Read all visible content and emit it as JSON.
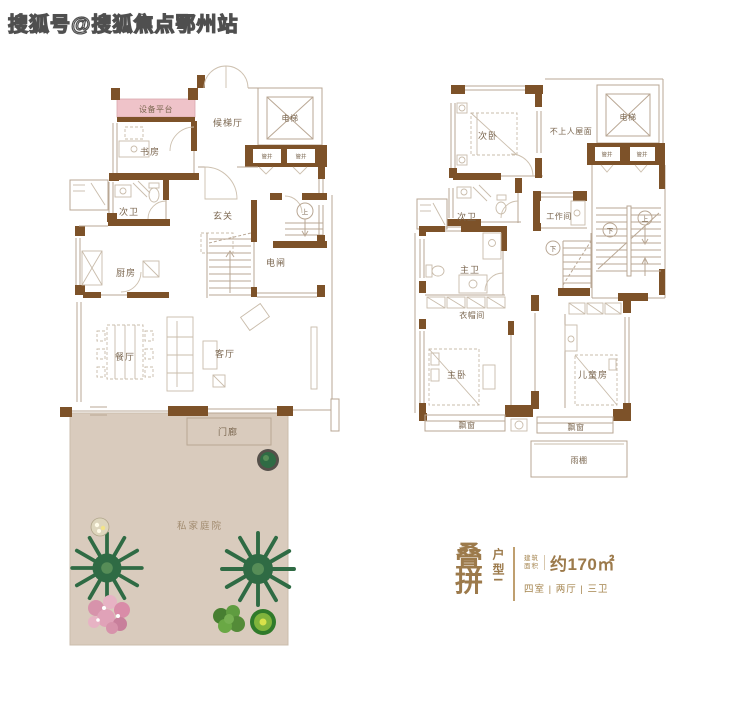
{
  "watermark": {
    "text": "搜狐号@搜狐焦点鄂州站"
  },
  "colors": {
    "wall": "#7d5229",
    "equipment_platform_pink": "#efc3c9",
    "courtyard_beige": "#d9cbbd",
    "label_brown": "#7b6750",
    "accent_bronze": "#9c7a4b",
    "plant_green": "#2f6b44"
  },
  "plan_lower": {
    "equipment_platform": "设备平台",
    "study": "书房",
    "elevator_lobby": "候梯厅",
    "elevator": "电梯",
    "pipe_shaft_a": "管井",
    "pipe_shaft_b": "管井",
    "bath2": "次卫",
    "foyer": "玄关",
    "stair_up": "上",
    "kitchen": "厨房",
    "switch_room": "电闸",
    "dining": "餐厅",
    "living": "客厅",
    "porch": "门廊",
    "courtyard": "私家庭院"
  },
  "plan_upper": {
    "bedroom2": "次卧",
    "roof": "不上人屋面",
    "elevator": "电梯",
    "pipe_shaft_a": "管井",
    "pipe_shaft_b": "管井",
    "bath2": "次卫",
    "workroom": "工作间",
    "stair_down_inner": "下",
    "stair_down": "下",
    "stair_up": "上",
    "master_bath": "主卫",
    "closet": "衣帽间",
    "master_bedroom": "主卧",
    "kids_room": "儿童房",
    "bay_window_a": "飘窗",
    "bay_window_b": "飘窗",
    "canopy": "雨棚"
  },
  "info": {
    "type_char_1": "叠",
    "type_char_2": "拼",
    "type_label": "户型I",
    "area_caption_1": "建筑",
    "area_caption_2": "面积",
    "area_value": "约170㎡",
    "rooms_summary": "四室 | 两厅 | 三卫"
  }
}
